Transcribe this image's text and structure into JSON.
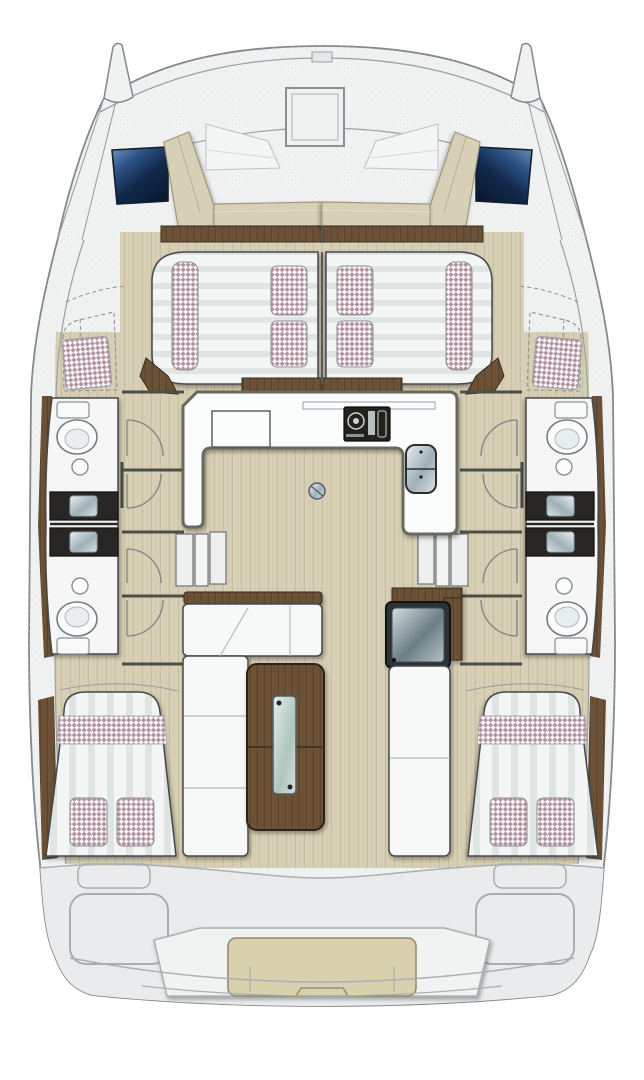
{
  "meta": {
    "title": "Catamaran yacht accommodation floor plan (overhead view)",
    "orientation": "bow at top, stern at bottom",
    "text_content": "none — the drawing contains no visible text labels"
  },
  "palette": {
    "bg": "#ffffff",
    "hull": "#f0f2f2",
    "hullEdge": "#82888d",
    "line": "#9aa0a5",
    "deck": "#e9ebec",
    "floor": "#d8d0b6",
    "floorLine": "#c8bea0",
    "wood": "#6d5338",
    "woodGrain": "#5a442c",
    "woodEdge": "#3a2c1d",
    "furnWhite": "#f7f8f8",
    "outline": "#45484b",
    "counterBlack": "#282726",
    "windowBlue1": "#6f94bf",
    "windowBlue2": "#2c5285",
    "windowBlue3": "#0a1a33",
    "tan": "#d7cfb6",
    "tanEdge": "#a39a7e",
    "check": "#b292a0",
    "checkBg": "#f8f5f6",
    "stripeLight": "#f3f6f5",
    "stripeDark": "#dfe5e2",
    "cushionTan": "#d9d0ae",
    "galleyEdge": "#676b60"
  },
  "areas": {
    "bow": [
      "port bow tip",
      "starboard bow tip",
      "foredeck",
      "square deck hatch",
      "bow notch fitting"
    ],
    "forward_cockpit": [
      "U-shaped tan bench seat",
      "two white sloped sunpad cushions",
      "two dark blue hull windows"
    ],
    "forward_cabin": [
      "two forward double berths with striped mattresses",
      "two checkered side bolsters",
      "four checkered pillows",
      "dark wood head and foot trim"
    ],
    "hulls": [
      "port hull: two bathrooms (toilet, round washbasin, black vanity with basin)",
      "starboard hull: mirrored two bathrooms",
      "dashed forepeak stowage with checkered cushion",
      "companionway steps (three treads) each side",
      "eight door swing arcs"
    ],
    "saloon": [
      "U-shaped white galley counter",
      "two-burner stove",
      "double sink",
      "floor table-mount circle",
      "L-shaped white settee with wood top rail",
      "dark wood saloon table with glass centre strip",
      "white bench",
      "dark cooler/ice box with glossy lid"
    ],
    "aft_cabins": [
      "port double bed with striped cover, checkered band and two checkered pillows",
      "starboard mirrored bed",
      "dark wood wardrobe strips"
    ],
    "stern": [
      "aft deck",
      "central helm/bench seat with tan cushion",
      "two rounded locker outlines",
      "two step notches",
      "curved swim platform lines"
    ]
  },
  "counts": {
    "hull_windows": 2,
    "forward_berths": 2,
    "forward_pillows": 4,
    "forward_bolsters": 2,
    "toilets": 4,
    "round_washbasins": 4,
    "vanity_basins": 4,
    "door_arcs": 8,
    "step_treads_per_side": 3,
    "aft_beds": 2,
    "aft_pillows_per_bed": 2,
    "stove_burners": 2,
    "sink_bowls": 2
  }
}
